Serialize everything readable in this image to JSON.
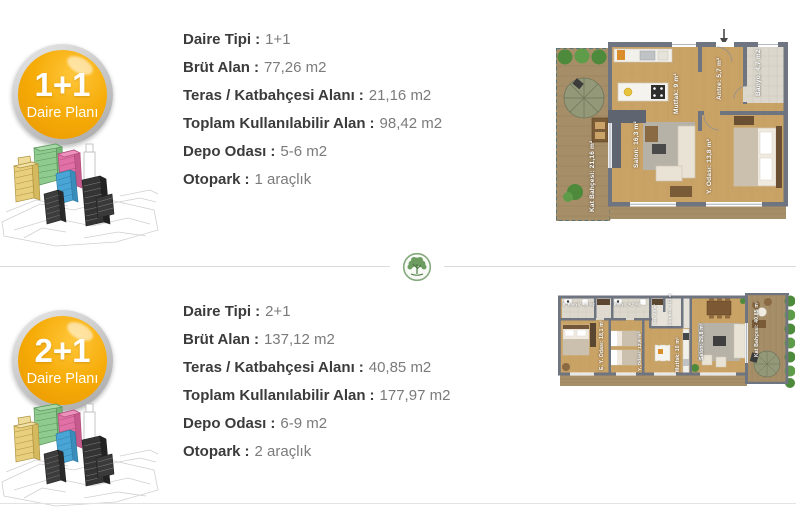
{
  "ui": {
    "separator": ":"
  },
  "colors": {
    "badge_orange": "#f2a70a",
    "label_text": "#3b3b3b",
    "value_text": "#7b7b7b",
    "logo_green": "#6c9c60",
    "plan_wall_gray": "#6e7480",
    "plan_wood": "#c9a266"
  },
  "divider": {
    "logo": "tree-logo"
  },
  "sections": [
    {
      "id": "plan-1-1",
      "badge": {
        "type": "1+1",
        "subtitle": "Daire Planı"
      },
      "specs": [
        {
          "label": "Daire Tipi",
          "value": "1+1"
        },
        {
          "label": "Brüt Alan",
          "value": "77,26 m2"
        },
        {
          "label": "Teras / Katbahçesi Alanı",
          "value": "21,16 m2"
        },
        {
          "label": "Toplam Kullanılabilir Alan",
          "value": "98,42 m2"
        },
        {
          "label": "Depo Odası",
          "value": "5-6 m2"
        },
        {
          "label": "Otopark",
          "value": "1 araçlık"
        }
      ],
      "floorplan": {
        "rooms": {
          "kat_bahcesi": "Kat Bahçesi: 21,16 m²",
          "mutfak": "Mutfak: 9 m²",
          "salon": "Salon: 16,3 m²",
          "antre": "Antre: 5,7 m²",
          "banyo": "Banyo: 4,7 m2",
          "y_odasi": "Y. Odası: 13,8 m²"
        }
      }
    },
    {
      "id": "plan-2-1",
      "badge": {
        "type": "2+1",
        "subtitle": "Daire Planı"
      },
      "specs": [
        {
          "label": "Daire Tipi",
          "value": "2+1"
        },
        {
          "label": "Brüt Alan",
          "value": "137,12 m2"
        },
        {
          "label": "Teras / Katbahçesi Alanı",
          "value": "40,85 m2"
        },
        {
          "label": "Toplam Kullanılabilir Alan",
          "value": "177,97 m2"
        },
        {
          "label": "Depo Odası",
          "value": "6-9 m2"
        },
        {
          "label": "Otopark",
          "value": "2 araçlık"
        }
      ],
      "floorplan": {
        "rooms": {
          "e_banyo": "E. Banyo: 4,8 m2",
          "banyo": "Banyo: 4,2 m2",
          "e_y_odasi": "E. Y. Odası: 18,1 m²",
          "y_odasi": "Y. Odası: 12,6 m²",
          "ves": "Ves: 2,5 m²",
          "giris_holu": "Giriş Holü: 11,3 m²",
          "mutfak": "Mutfak: 10 m²",
          "salon": "Salon: 29,8 m²",
          "kat_bahcesi": "Kat Bahçesi: 40,85 m²"
        }
      }
    }
  ]
}
